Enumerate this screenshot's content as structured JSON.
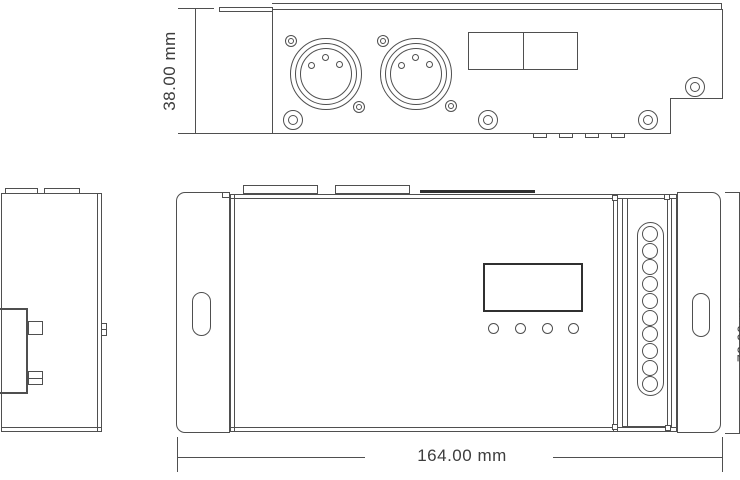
{
  "page": {
    "background": "#ffffff"
  },
  "colors": {
    "line": "#4f4f4f",
    "line_dark": "#303030",
    "text": "#3d3d3d"
  },
  "dimension_labels": {
    "top_view_height": "38.00 mm",
    "front_view_width": "164.00 mm",
    "front_view_height_partial": "72.00 mm"
  },
  "top_view": {
    "xlr_connector_count": 2,
    "xlr_pin_count": 3,
    "bottom_tab_count": 4,
    "terminal_block_cells": 2,
    "large_screw_count": 4,
    "small_screw_count": 4
  },
  "side_view": {
    "top_tab_count": 2
  },
  "front_view": {
    "button_count": 4,
    "terminal_hole_count": 10,
    "mounting_slot_count": 2,
    "top_tab_count": 2
  }
}
